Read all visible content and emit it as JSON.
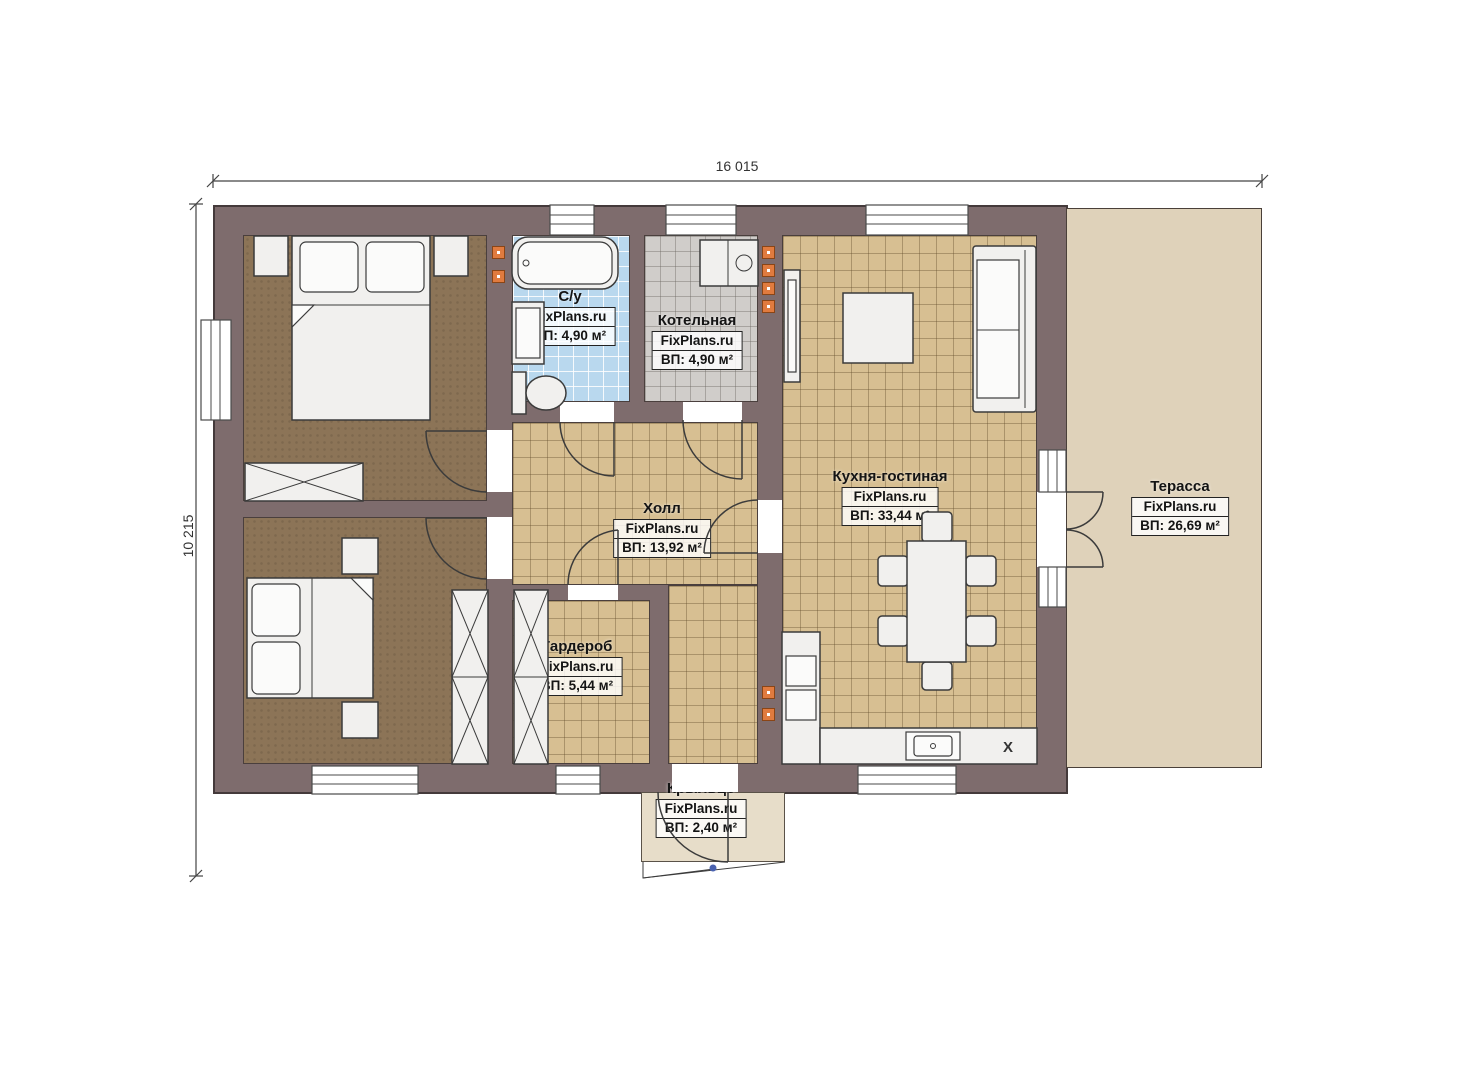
{
  "dimensions": {
    "width": "16 015",
    "height": "10 215"
  },
  "rooms": [
    {
      "key": "bedroom-1",
      "name": "Спальня",
      "brand": "FixPlans.ru",
      "area": "ВП: 14,95 м²"
    },
    {
      "key": "bedroom-2",
      "name": "Спальня",
      "brand": "FixPlans.ru",
      "area": "ВП: 14,95 м²"
    },
    {
      "key": "bathroom",
      "name": "С/у",
      "brand": "FixPlans.ru",
      "area": "ВП: 4,90 м²"
    },
    {
      "key": "boiler-room",
      "name": "Котельная",
      "brand": "FixPlans.ru",
      "area": "ВП: 4,90 м²"
    },
    {
      "key": "hall",
      "name": "Холл",
      "brand": "FixPlans.ru",
      "area": "ВП: 13,92 м²"
    },
    {
      "key": "wardrobe",
      "name": "Гардероб",
      "brand": "FixPlans.ru",
      "area": "ВП: 5,44 м²"
    },
    {
      "key": "kitchen-living",
      "name": "Кухня-гостиная",
      "brand": "FixPlans.ru",
      "area": "ВП: 33,44 м²"
    },
    {
      "key": "terrace",
      "name": "Терасса",
      "brand": "FixPlans.ru",
      "area": "ВП: 26,69 м²"
    },
    {
      "key": "porch",
      "name": "Крыльцо",
      "brand": "FixPlans.ru",
      "area": "ВП: 2,40 м²"
    }
  ],
  "annotations": {
    "fridge_marker": "X"
  },
  "colors": {
    "wall": "#7e6c6d",
    "wall_edge": "#443a3b",
    "wood_floor": "#8c7457",
    "tile_tan": "#d7bf92",
    "tile_blue": "#b9d8ee",
    "tile_gray": "#d0cdca",
    "terrace": "#dfd2ba",
    "porch": "#e7ddc9",
    "line": "#3b3b3b",
    "outlet": "#e07b3f",
    "step_dot": "#4a62b0"
  }
}
